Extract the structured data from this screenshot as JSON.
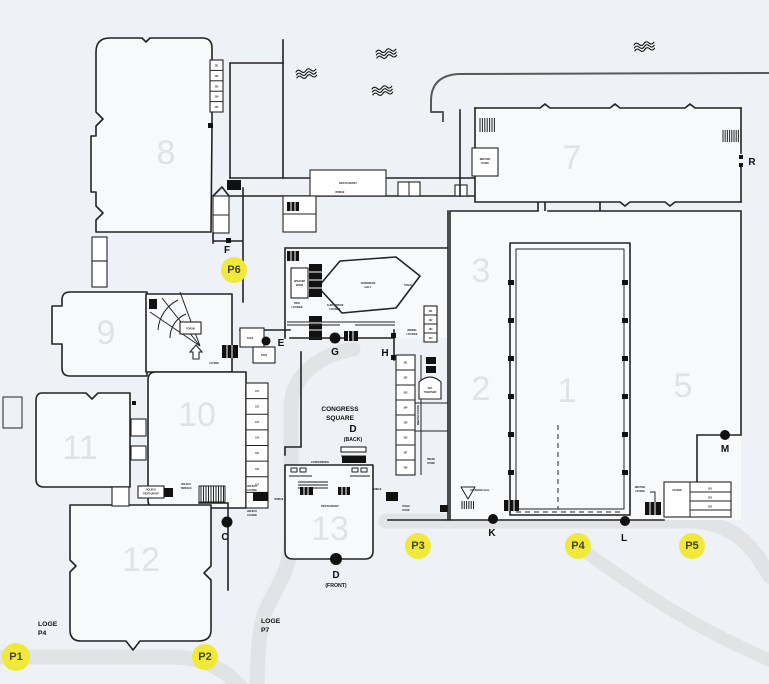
{
  "colors": {
    "bg": "#eef1f6",
    "building": "#f7f9fb",
    "wall": "#232323",
    "outer_boundary": "#595959",
    "road": "#e2e3e6",
    "hall_number": "#dfe2e7",
    "parking_fill": "#f1e93a",
    "parking_text": "#454520",
    "marker": "#111111"
  },
  "halls": {
    "h1": "1",
    "h2": "2",
    "h3": "3",
    "h5": "5",
    "h7": "7",
    "h8": "8",
    "h9": "9",
    "h10": "10",
    "h11": "11",
    "h12": "12",
    "h13": "13"
  },
  "entrances": {
    "c": "C",
    "e": "E",
    "f": "F",
    "g": "G",
    "h": "H",
    "k": "K",
    "l": "L",
    "m": "M",
    "r": "R",
    "d_back": "D",
    "d_back_sub": "(BACK)",
    "d_front": "D",
    "d_front_sub": "(FRONT)"
  },
  "parking": {
    "p1": "P1",
    "p2": "P2",
    "p3": "P3",
    "p4": "P4",
    "p5": "P5",
    "p6": "P6"
  },
  "loge": {
    "p0_line1": "LOGE",
    "p0_line2": "P0",
    "p4_line1": "LOGE",
    "p4_line2": "P4",
    "p7_line1": "LOGE",
    "p7_line2": "P7"
  },
  "labels": {
    "congress_square_1": "CONGRESS",
    "congress_square_2": "SQUARE",
    "restaurant_bridge": "RESTAURANT",
    "bridge_top": "BRIDGE",
    "speaker_1": "SPEAKER",
    "speaker_2": "ROOM",
    "org_1": "ORG",
    "org_2": "LOUNGE",
    "aud_1": "AUDITORIUM",
    "aud_2": "LOUNGE",
    "hex_1": "CONGRESS",
    "hex_2": "HALL",
    "stage": "STAGE",
    "dining_1": "DINING",
    "dining_2": "LOUNGE",
    "meeting_rooms": "MEETING ROOMS",
    "get_1": "GET",
    "get_2": "TOGETHER",
    "press_1": "PRESS",
    "press_2": "ROOM",
    "conference": "CONFERENCE",
    "restaurant_13": "RESTAURANT",
    "stage_door_1": "STAGE",
    "stage_door_2": "DOOR",
    "entrance_hall": "ENTRANCE HALL",
    "meeting_lounge_1": "MEETING",
    "meeting_lounge_2": "LOUNGE",
    "lounge_block": "LOUNGE",
    "room7_1": "MEETING",
    "room7_2": "ROOM",
    "forum": "FORUM",
    "fan_lounge": "LOUNGE",
    "cafe_1": "CAFE",
    "cafe_2": "CAFE",
    "holiday_rest_1": "HOLIDAY",
    "holiday_rest_2": "RESTAURANT",
    "holiday_terr_1": "HOLIDAY",
    "holiday_terr_2": "TERRACE",
    "holiday_lounge_up_1": "HOLIDAY",
    "holiday_lounge_up_2": "LOUNGE",
    "holiday_lounge_lo_1": "HOLIDAY",
    "holiday_lounge_lo_2": "LOUNGE",
    "bridge_c": "BRIDGE",
    "bridge_d": "BRIDGE"
  },
  "rooms": {
    "h8_stack": [
      "201",
      "202",
      "203",
      "204",
      "205"
    ],
    "west": [
      "101",
      "102",
      "103",
      "104",
      "105",
      "106",
      "107",
      "108"
    ],
    "meeting_strip": [
      "301",
      "302",
      "303",
      "304",
      "305",
      "306",
      "307",
      "308"
    ],
    "hex_stack": [
      "401",
      "402",
      "403",
      "404"
    ],
    "l_block": [
      "501",
      "502",
      "503"
    ]
  }
}
